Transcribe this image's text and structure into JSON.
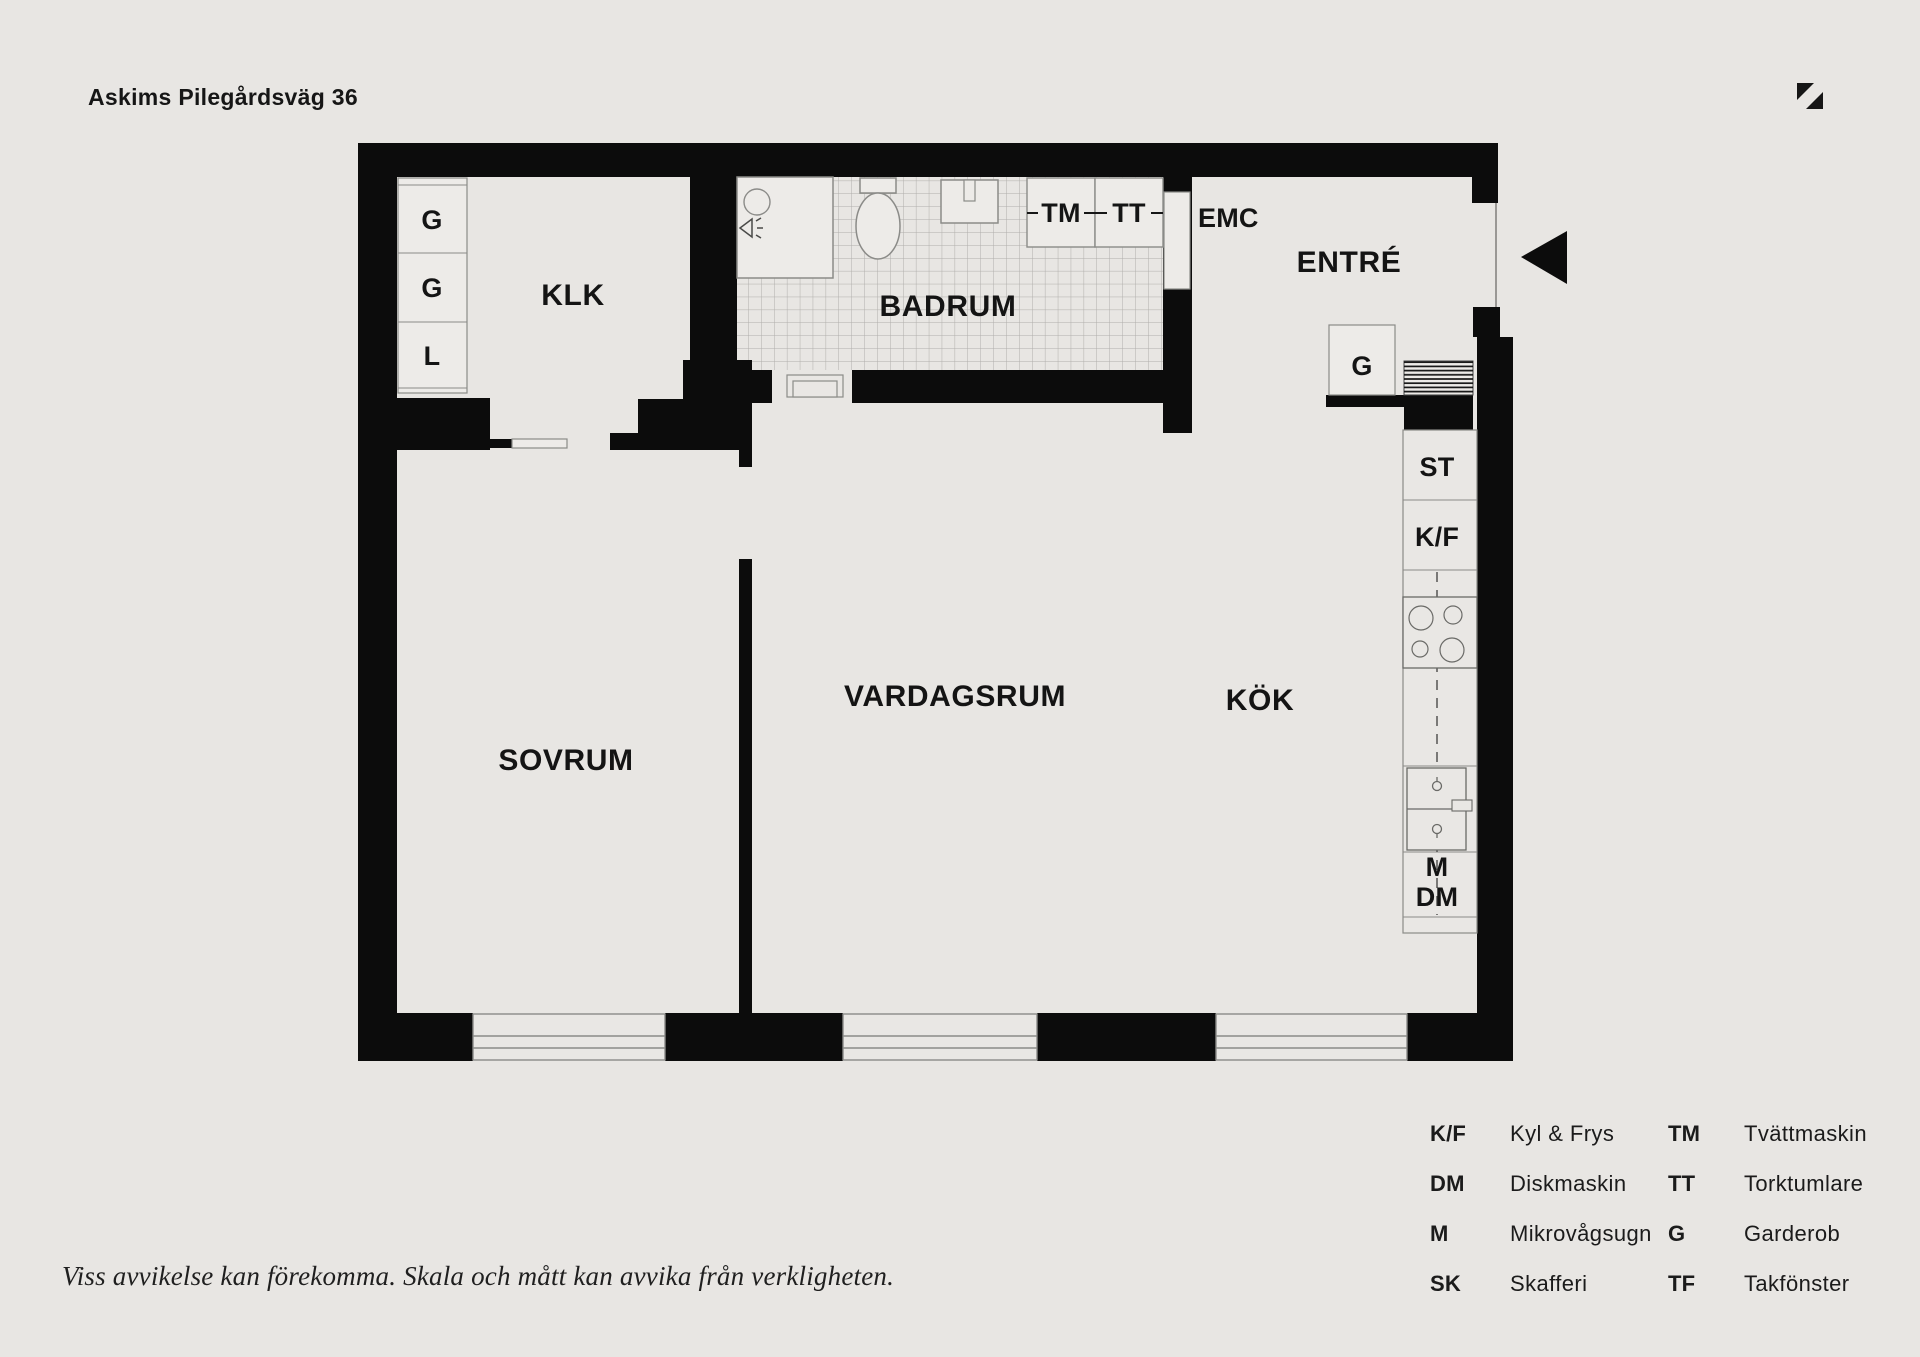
{
  "header": {
    "title": "Askims Pilegårdsväg 36",
    "north_icon": "north-arrow-icon"
  },
  "floorplan": {
    "rooms": {
      "klk": "KLK",
      "badrum": "BADRUM",
      "entre": "ENTRÉ",
      "sovrum": "SOVRUM",
      "vardagsrum": "VARDAGSRUM",
      "kok": "KÖK"
    },
    "markers": {
      "emc": "EMC",
      "wardrobe_1": "G",
      "wardrobe_2": "G",
      "linen_closet": "L",
      "washing_machine": "TM",
      "dryer": "TT",
      "entre_wardrobe": "G",
      "pantry_cabinet": "ST",
      "fridge_freezer": "K/F",
      "microwave": "M",
      "dishwasher": "DM"
    }
  },
  "legend": {
    "items": [
      {
        "abbr": "K/F",
        "label": "Kyl & Frys"
      },
      {
        "abbr": "TM",
        "label": "Tvättmaskin"
      },
      {
        "abbr": "DM",
        "label": "Diskmaskin"
      },
      {
        "abbr": "TT",
        "label": "Torktumlare"
      },
      {
        "abbr": "M",
        "label": "Mikrovågsugn"
      },
      {
        "abbr": "G",
        "label": "Garderob"
      },
      {
        "abbr": "SK",
        "label": "Skafferi"
      },
      {
        "abbr": "TF",
        "label": "Takfönster"
      }
    ]
  },
  "footer": {
    "disclaimer": "Viss avvikelse kan förekomma. Skala och mått kan avvika från verkligheten."
  },
  "colors": {
    "background": "#e8e6e3",
    "wall": "#0c0c0c",
    "fixture_fill": "#edebe8",
    "fixture_line": "#8b8b88",
    "tile_line": "#b0aeab"
  }
}
